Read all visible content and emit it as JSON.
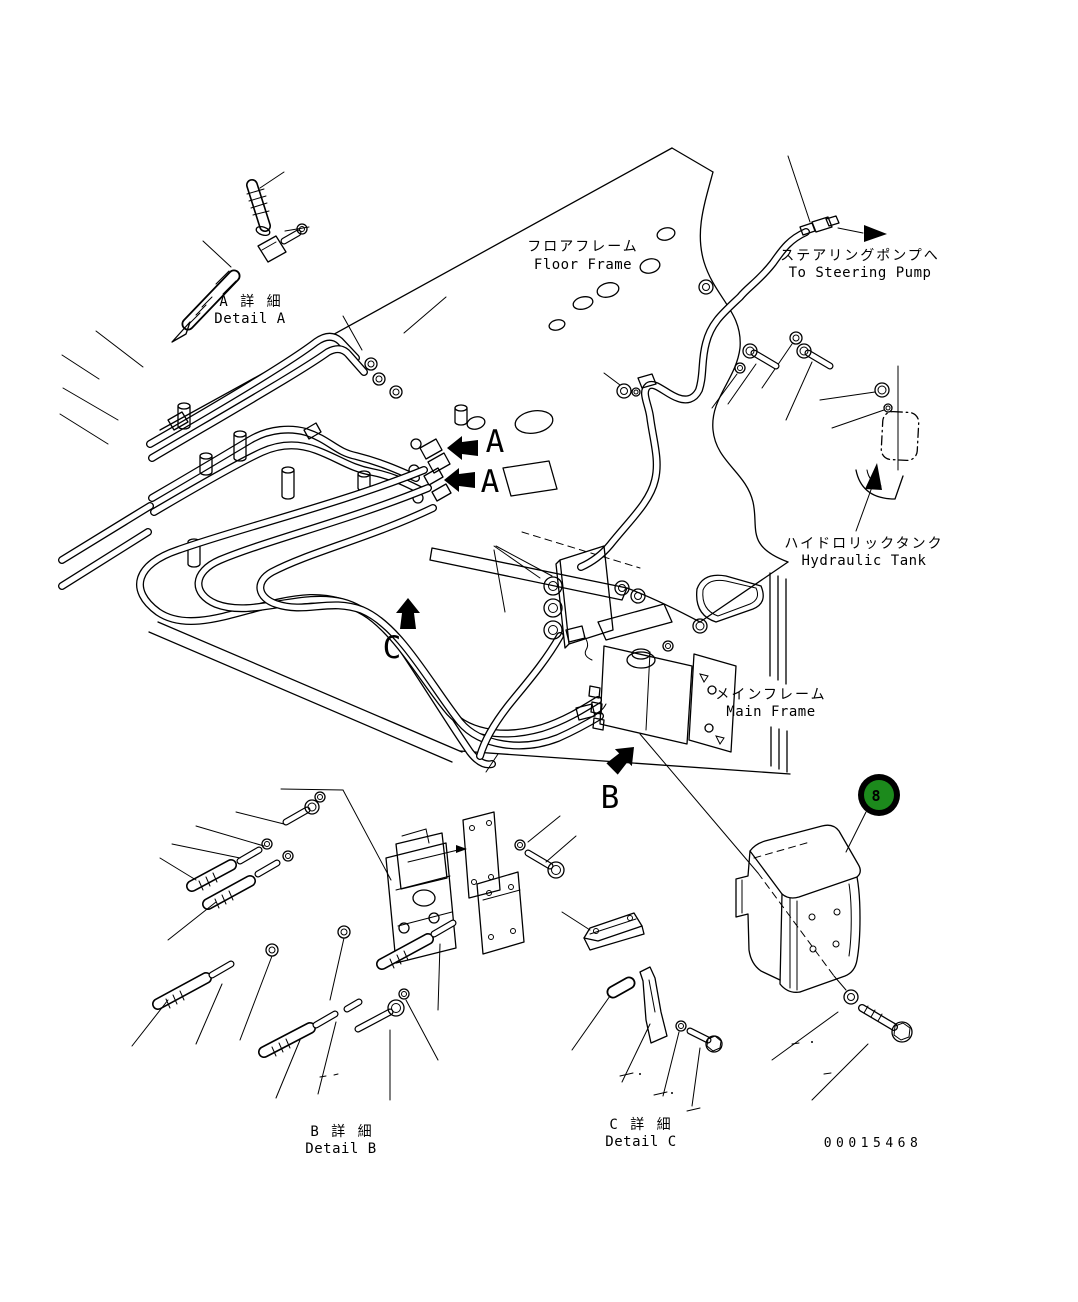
{
  "page": {
    "background_color": "#ffffff",
    "line_color": "#000000",
    "drawing_number": "00015468"
  },
  "labels": {
    "floor_frame_jp": "フロアフレーム",
    "floor_frame_en": "Floor Frame",
    "steering_pump_jp": "ステアリングポンプへ",
    "steering_pump_en": "To Steering Pump",
    "hydraulic_tank_jp": "ハイドロリックタンク",
    "hydraulic_tank_en": "Hydraulic Tank",
    "main_frame_jp": "メインフレーム",
    "main_frame_en": "Main Frame",
    "detail_a_jp": "A 詳 細",
    "detail_a_en": "Detail A",
    "detail_b_jp": "B 詳 細",
    "detail_b_en": "Detail B",
    "detail_c_jp": "C 詳 細",
    "detail_c_en": "Detail C"
  },
  "markers": {
    "section_a_upper": "A",
    "section_a_lower": "A",
    "section_b": "B",
    "section_c": "C"
  },
  "callout": {
    "number": "8",
    "fill_color": "#1c8a1c",
    "ring_color": "#000000",
    "number_color": "#ffffff"
  }
}
